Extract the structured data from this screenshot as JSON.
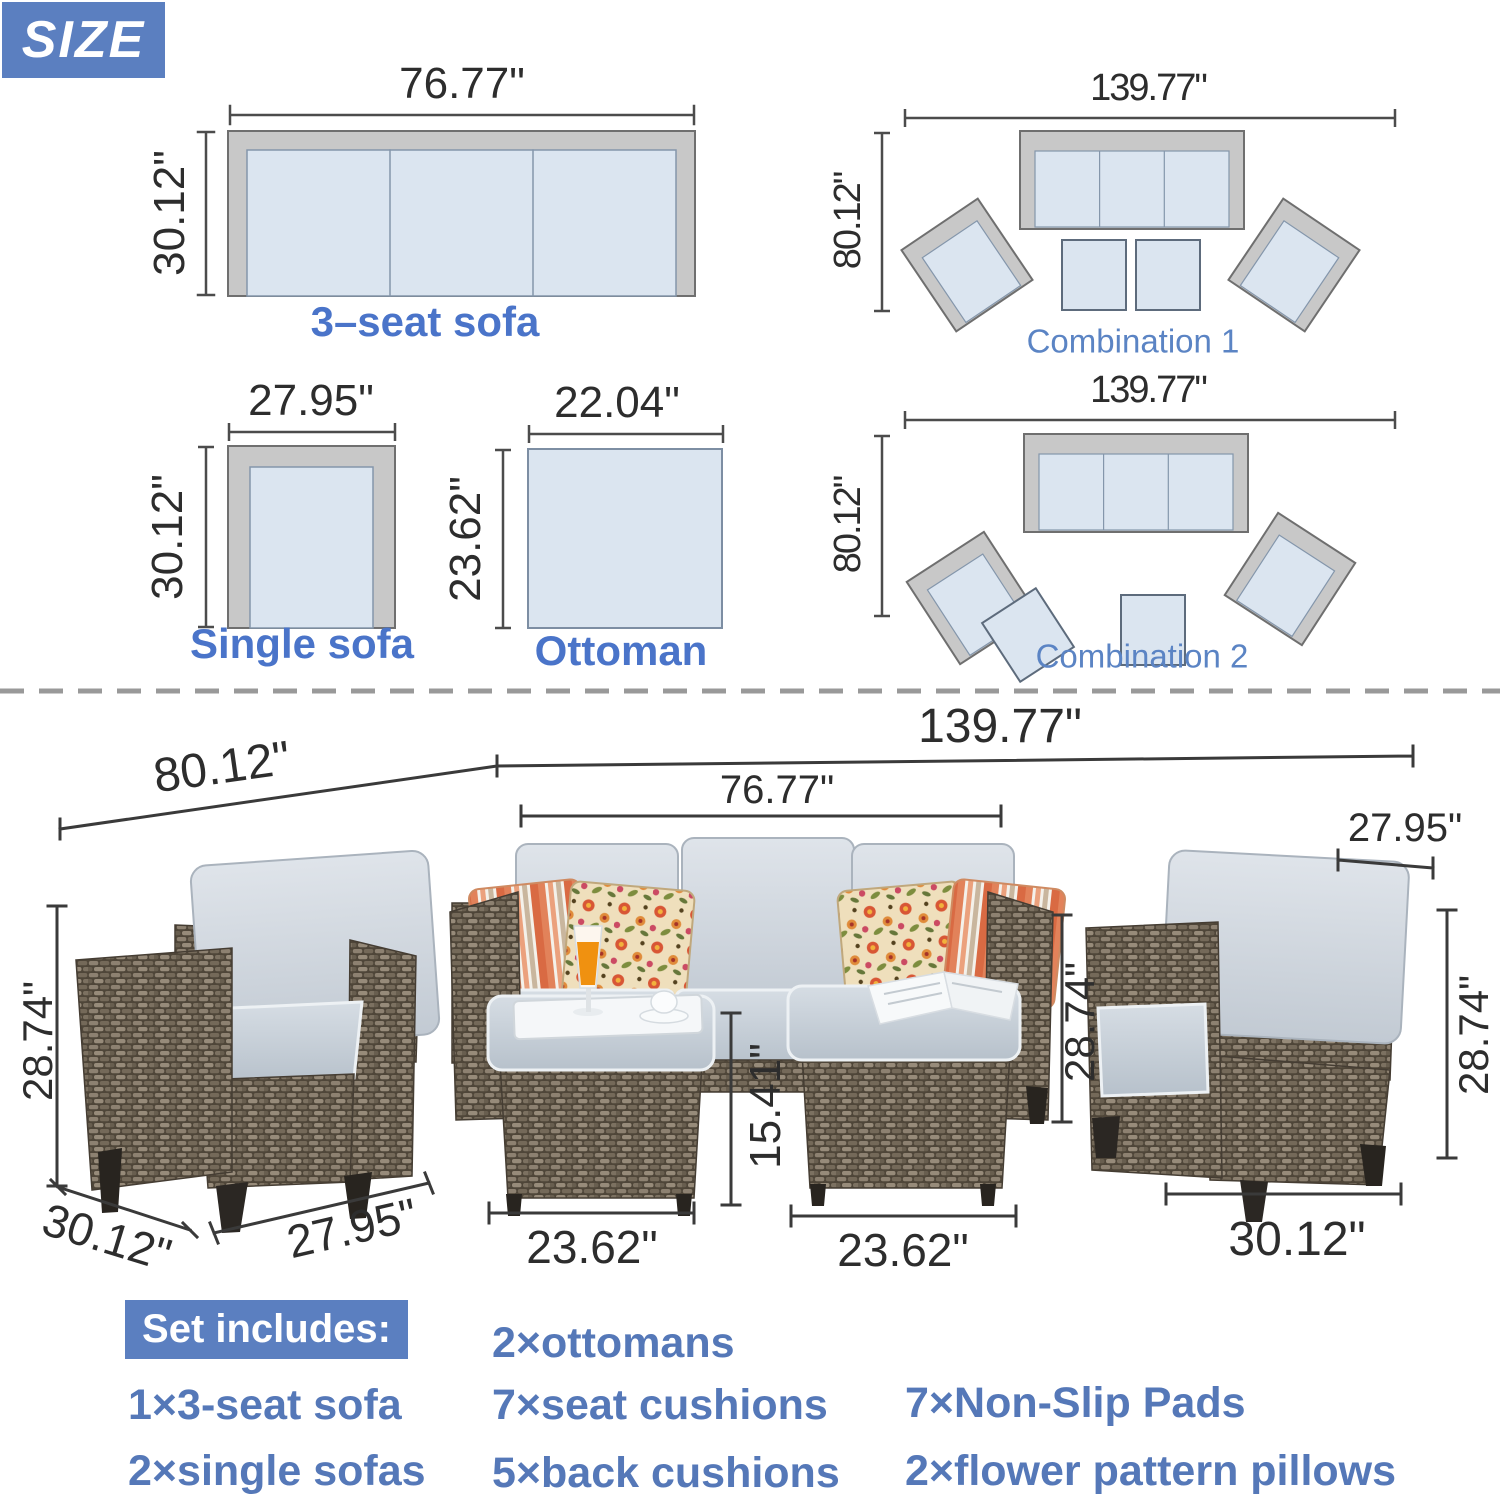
{
  "title_badge": "SIZE",
  "colors": {
    "accent_blue": "#5b7fc0",
    "label_blue": "#4a74c9",
    "combo_label_blue": "#5b84c4",
    "list_blue": "#5578b8",
    "dim_text": "#2d2d2d",
    "cushion_blue": "#dbe5f0",
    "frame_gray": "#c8c8c8"
  },
  "diagrams": {
    "three_seat": {
      "label": "3–seat sofa",
      "width": "76.77\"",
      "depth": "30.12\""
    },
    "single": {
      "label": "Single sofa",
      "width": "27.95\"",
      "depth": "30.12\""
    },
    "ottoman": {
      "label": "Ottoman",
      "width": "22.04\"",
      "depth": "23.62\""
    },
    "combo1": {
      "label": "Combination 1",
      "width": "139.77\"",
      "depth": "80.12\""
    },
    "combo2": {
      "label": "Combination 2",
      "width": "139.77\"",
      "depth": "80.12\""
    }
  },
  "photo_dims": {
    "set_depth": "80.12\"",
    "set_width": "139.77\"",
    "sofa_width": "76.77\"",
    "right_chair_top_width": "27.95\"",
    "left_chair_height": "28.74\"",
    "left_chair_depth": "30.12\"",
    "left_chair_width": "27.95\"",
    "ottoman_height": "15.41\"",
    "left_ottoman_width": "23.62\"",
    "right_ottoman_width": "23.62\"",
    "sofa_height": "28.74\"",
    "right_chair_height": "28.74\"",
    "right_chair_depth": "30.12\""
  },
  "set_includes": {
    "title": "Set includes:",
    "items_col1": [
      "1×3-seat sofa",
      "2×single sofas"
    ],
    "items_col2": [
      "2×ottomans",
      "7×seat cushions",
      "5×back cushions"
    ],
    "items_col3": [
      "7×Non-Slip Pads",
      "2×flower pattern pillows"
    ]
  }
}
